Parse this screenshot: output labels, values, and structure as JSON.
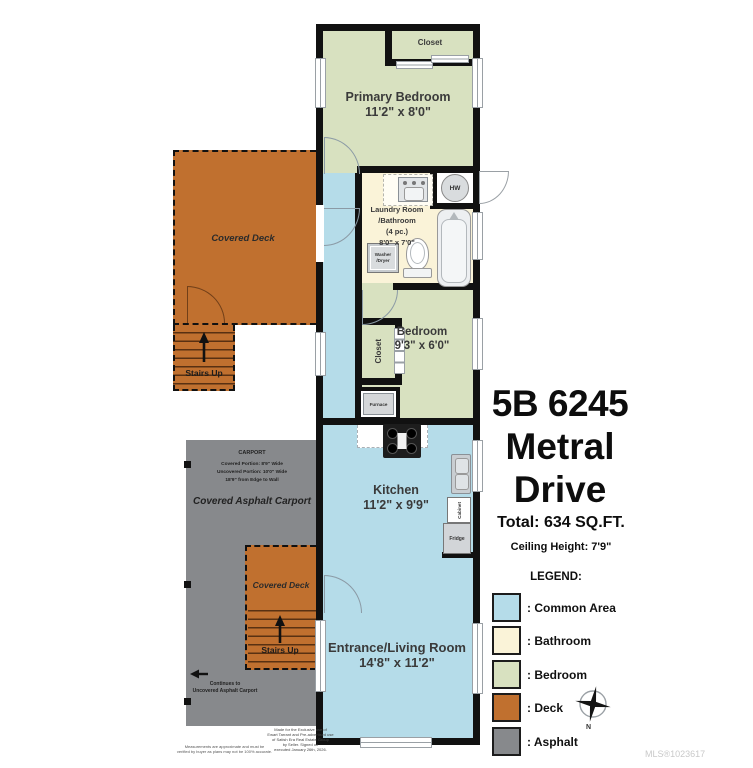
{
  "colors": {
    "wall": "#111111",
    "common_area": "#b5dce9",
    "bathroom": "#faf3d8",
    "bedroom": "#d8e1c0",
    "deck": "#c0702f",
    "asphalt": "#87898c",
    "background": "#ffffff"
  },
  "plan": {
    "rooms": {
      "primary_bedroom": {
        "name": "Primary Bedroom",
        "dims": "11'2\" x 8'0\""
      },
      "closet_top": {
        "name": "Closet"
      },
      "laundry": {
        "l1": "Laundry Room",
        "l2": "/Bathroom",
        "l3": "(4 pc.)",
        "l4": "8'0\" x 7'0\""
      },
      "bedroom": {
        "name": "Bedroom",
        "dims": "9'3\" x 6'0\""
      },
      "closet_mid": {
        "name": "Closet"
      },
      "kitchen": {
        "name": "Kitchen",
        "dims": "11'2\" x 9'9\""
      },
      "living": {
        "name": "Entrance/Living Room",
        "dims": "14'8\" x 11'2\""
      }
    },
    "fixtures": {
      "hw": "HW",
      "washer_l1": "Washer",
      "washer_l2": "/Dryer",
      "furnace": "Furnace",
      "cabinet": "Cabinet",
      "fridge": "Fridge"
    },
    "outdoor": {
      "deck_upper": "Covered Deck",
      "deck_lower": "Covered Deck",
      "stairs_upper": "Stairs Up",
      "stairs_lower": "Stairs Up",
      "carport_heading": "CARPORT",
      "carport_l1": "Covered Portion: 8'9\" Wide",
      "carport_l2": "Uncovered Portion: 10'0\" Wide",
      "carport_l3": "18'9\" from Edge to Wall",
      "carport_label": "Covered Asphalt Carport",
      "continues_l1": "Continues to",
      "continues_l2": "Uncovered Asphalt Carport"
    }
  },
  "info": {
    "title_l1": "5B 6245",
    "title_l2": "Metral",
    "title_l3": "Drive",
    "total": "Total: 634 SQ.FT.",
    "ceiling": "Ceiling Height: 7'9\""
  },
  "legend": {
    "heading": "LEGEND:",
    "north": "N",
    "items": [
      {
        "label": ": Common Area",
        "color": "#b5dce9"
      },
      {
        "label": ": Bathroom",
        "color": "#faf3d8"
      },
      {
        "label": ": Bedroom",
        "color": "#d8e1c0"
      },
      {
        "label": ": Deck",
        "color": "#c0702f"
      },
      {
        "label": ": Asphalt",
        "color": "#87898c"
      }
    ]
  },
  "footer": {
    "left_l1": "Measurements are approximate and must be",
    "left_l2": "verified by buyer as plans may not be 100% accurate.",
    "center_l1": "Made for the Exclusive use of",
    "center_l2": "Ewart Tarrant and Pre-advertised use",
    "center_l3": "of Satish Era Real Estate Group",
    "center_l4": "by Seller. Signed on",
    "center_l5": "executed January 26th, 2026.",
    "mls": "MLS®1023617"
  }
}
